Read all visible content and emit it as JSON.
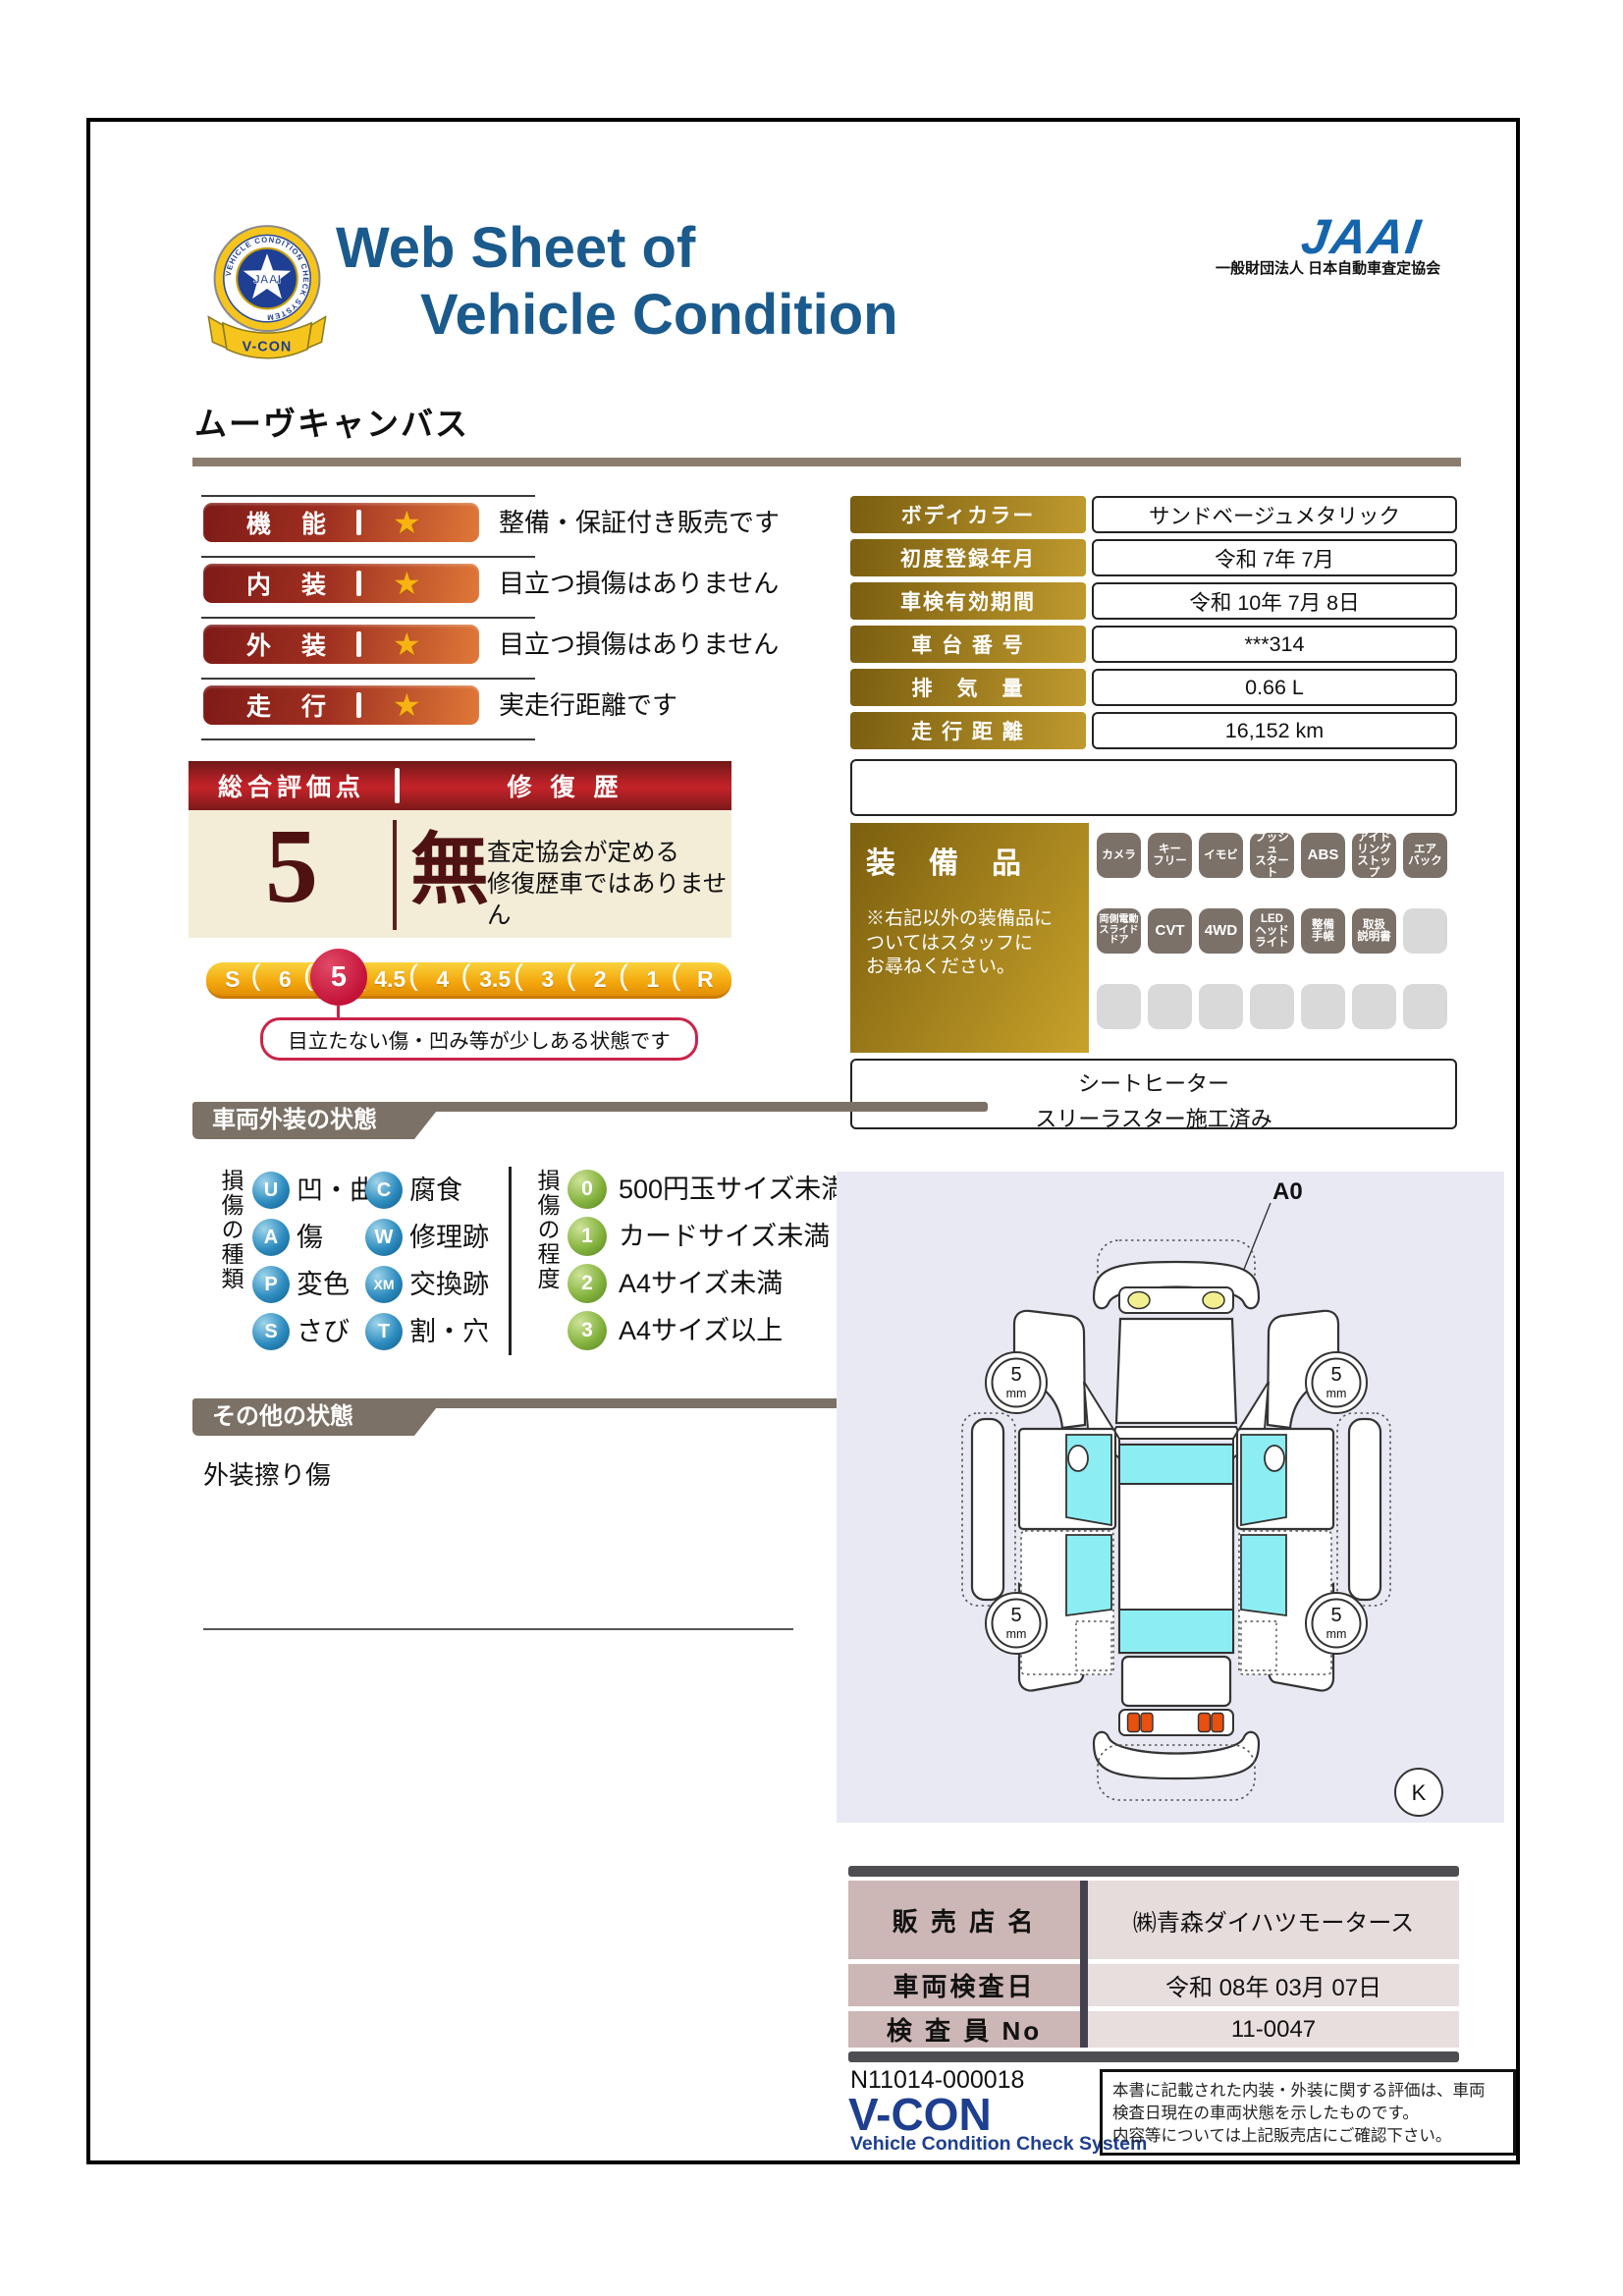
{
  "colors": {
    "title_blue": "#1a5a8c",
    "jaai_blue": "#1565ad",
    "vcon_navy": "#1e3f8f",
    "badge_red": "#7e1a18",
    "badge_orange": "#e07838",
    "star_gold": "#f7b312",
    "gold_label": "#c09a2e",
    "overall_red": "#c22329",
    "cream": "#f3ecd7",
    "maroon": "#4f1212",
    "scale_yellow": "#f3a70d",
    "selected_crimson": "#c41238",
    "section_taupe": "#7c7166",
    "divider_taupe": "#8b7d6e",
    "sphere_blue": "#2e8cc0",
    "sphere_green": "#86b440",
    "equip_gray": "#7b7168",
    "dealer_mauve": "#ccb6b6",
    "diagram_bg": "#e9e9f4",
    "window_cyan": "#8ceef2"
  },
  "header": {
    "badge_ring_text": "VEHICLE CONDITION CHECK SYSTEM",
    "badge_center_text": "JAAI",
    "badge_ribbon_text": "V-CON",
    "title_line1": "Web Sheet of",
    "title_line2": "Vehicle Condition",
    "jaai_wordmark": "JAAI",
    "jaai_subtitle": "一般財団法人 日本自動車査定協会"
  },
  "vehicle_name": "ムーヴキャンバス",
  "ratings": [
    {
      "label": "機　能",
      "description": "整備・保証付き販売です"
    },
    {
      "label": "内　装",
      "description": "目立つ損傷はありません"
    },
    {
      "label": "外　装",
      "description": "目立つ損傷はありません"
    },
    {
      "label": "走　行",
      "description": "実走行距離です"
    }
  ],
  "info_table": {
    "rows": [
      {
        "label": "ボディカラー",
        "value": "サンドベージュメタリック"
      },
      {
        "label": "初度登録年月",
        "value": "令和 7年 7月"
      },
      {
        "label": "車検有効期間",
        "value": "令和 10年 7月 8日"
      },
      {
        "label": "車 台 番 号",
        "value": "***314"
      },
      {
        "label": "排　気　量",
        "value": "0.66 L"
      },
      {
        "label": "走 行 距 離",
        "value": "16,152 km"
      }
    ]
  },
  "equipment": {
    "title": "装　備　品",
    "note": "※右記以外の装備品に\nついてはスタッフに\nお尋ねください。",
    "badges": [
      "カメラ",
      "キー\nフリー",
      "イモビ",
      "プッシュ\nスタート",
      "ABS",
      "アイド\nリング\nストップ",
      "エア\nバック",
      "両側電動\nスライド\nドア",
      "CVT",
      "4WD",
      "LED\nヘッド\nライト",
      "整備\n手帳",
      "取扱\n説明書"
    ],
    "extra_line1": "シートヒーター",
    "extra_line2": "スリーラスター施工済み"
  },
  "overall": {
    "header_left": "総合評価点",
    "header_right": "修 復 歴",
    "score": "5",
    "repair_flag": "無",
    "note_line1": "査定協会が定める",
    "note_line2": "修復歴車ではありません"
  },
  "scale": {
    "items": [
      "S",
      "6",
      "5",
      "4.5",
      "4",
      "3.5",
      "3",
      "2",
      "1",
      "R"
    ],
    "selected_value": "5",
    "note": "目立たない傷・凹み等が少しある状態です"
  },
  "exterior": {
    "title": "車両外装の状態",
    "kind_header": "損傷の種類",
    "kinds": [
      {
        "code": "U",
        "label": "凹・曲"
      },
      {
        "code": "A",
        "label": "傷"
      },
      {
        "code": "P",
        "label": "変色"
      },
      {
        "code": "S",
        "label": "さび"
      },
      {
        "code": "C",
        "label": "腐食"
      },
      {
        "code": "W",
        "label": "修理跡"
      },
      {
        "code": "XM",
        "label": "交換跡"
      },
      {
        "code": "T",
        "label": "割・穴"
      }
    ],
    "degree_header": "損傷の程度",
    "degrees": [
      {
        "code": "0",
        "label": "500円玉サイズ未満"
      },
      {
        "code": "1",
        "label": "カードサイズ未満"
      },
      {
        "code": "2",
        "label": "A4サイズ未満"
      },
      {
        "code": "3",
        "label": "A4サイズ以上"
      }
    ]
  },
  "diagram": {
    "annotation": "A0",
    "wheel_value": "5",
    "wheel_unit": "mm",
    "corner_mark": "K"
  },
  "other": {
    "title": "その他の状態",
    "note": "外装擦り傷"
  },
  "dealer": {
    "rows": [
      {
        "label": "販 売 店 名",
        "value": "㈱青森ダイハツモータース"
      },
      {
        "label": "車両検査日",
        "value": "令和 08年 03月 07日"
      },
      {
        "label": "検 査 員 No",
        "value": "11-0047"
      }
    ]
  },
  "footer": {
    "doc_number": "N11014-000018",
    "logo": "V-CON",
    "logo_subtitle": "Vehicle Condition Check System",
    "disclaimer": "本書に記載された内装・外装に関する評価は、車両\n検査日現在の車両状態を示したものです。\n内容等については上記販売店にご確認下さい。"
  }
}
